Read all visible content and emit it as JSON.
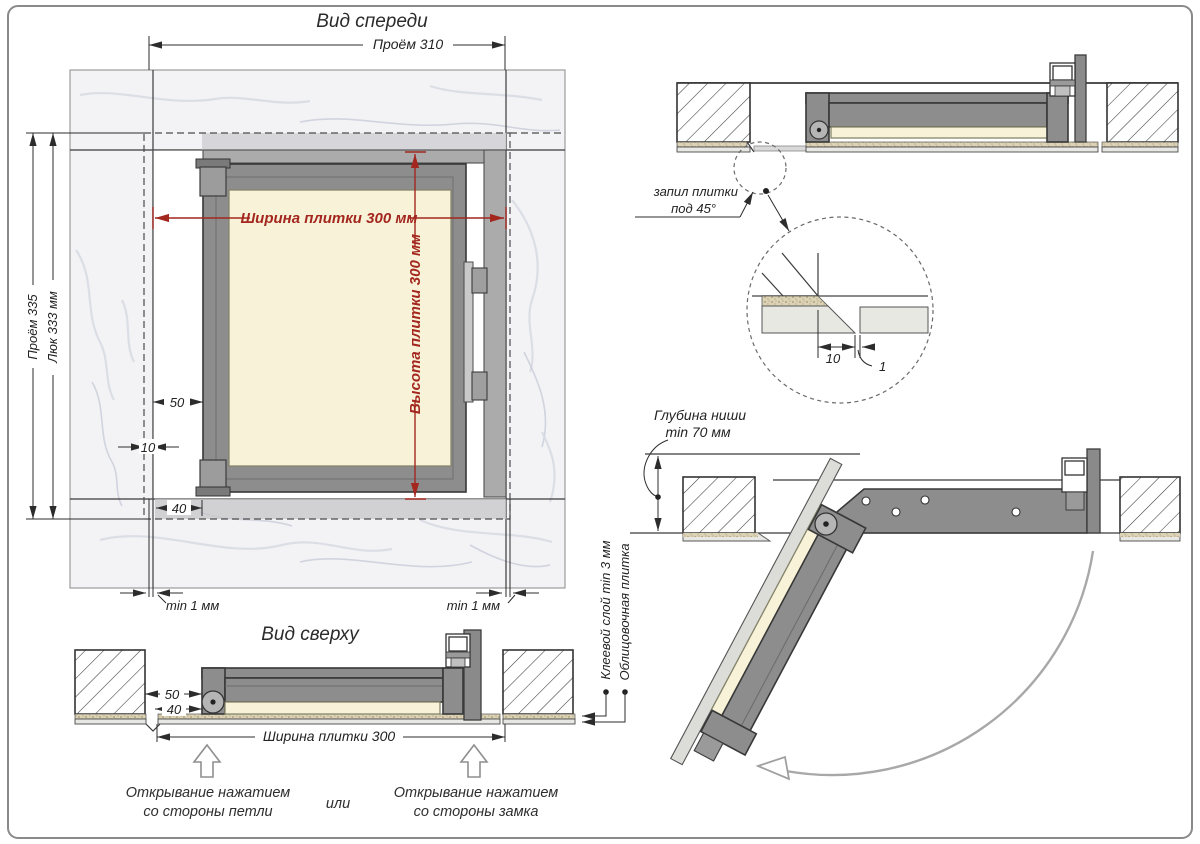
{
  "front_view": {
    "title": "Вид спереди",
    "dim_top": "Проём 310",
    "dim_left_outer": "Проём 335",
    "dim_left_inner": "Люк 333 мм",
    "tile_width": "Ширина плитки 300 мм",
    "tile_height": "Высота плитки 300 мм",
    "dim_50": "50",
    "dim_10": "10",
    "dim_40": "40",
    "gap_left": "min 1 мм",
    "gap_right": "min 1 мм"
  },
  "top_view": {
    "title": "Вид сверху",
    "dim_50": "50",
    "dim_40": "40",
    "tile_width": "Ширина плитки 300",
    "open_hinge_1": "Открывание нажатием",
    "open_hinge_2": "со стороны петли",
    "or_label": "или",
    "open_latch_1": "Открывание нажатием",
    "open_latch_2": "со стороны замка"
  },
  "section_view": {
    "cut_label_1": "запил плитки",
    "cut_label_2": "под 45°",
    "detail_10": "10",
    "detail_1": "1"
  },
  "open_view": {
    "niche_1": "Глубина ниши",
    "niche_2": "min 70 мм",
    "glue_label": "Клеевой слой min 3 мм",
    "tile_label": "Облицовочная плитка"
  },
  "colors": {
    "accent_red": "#a3271f",
    "frame_gray": "#8d8d8d",
    "tile_cream": "#f8f3d8",
    "marble": "#f3f3f6"
  }
}
